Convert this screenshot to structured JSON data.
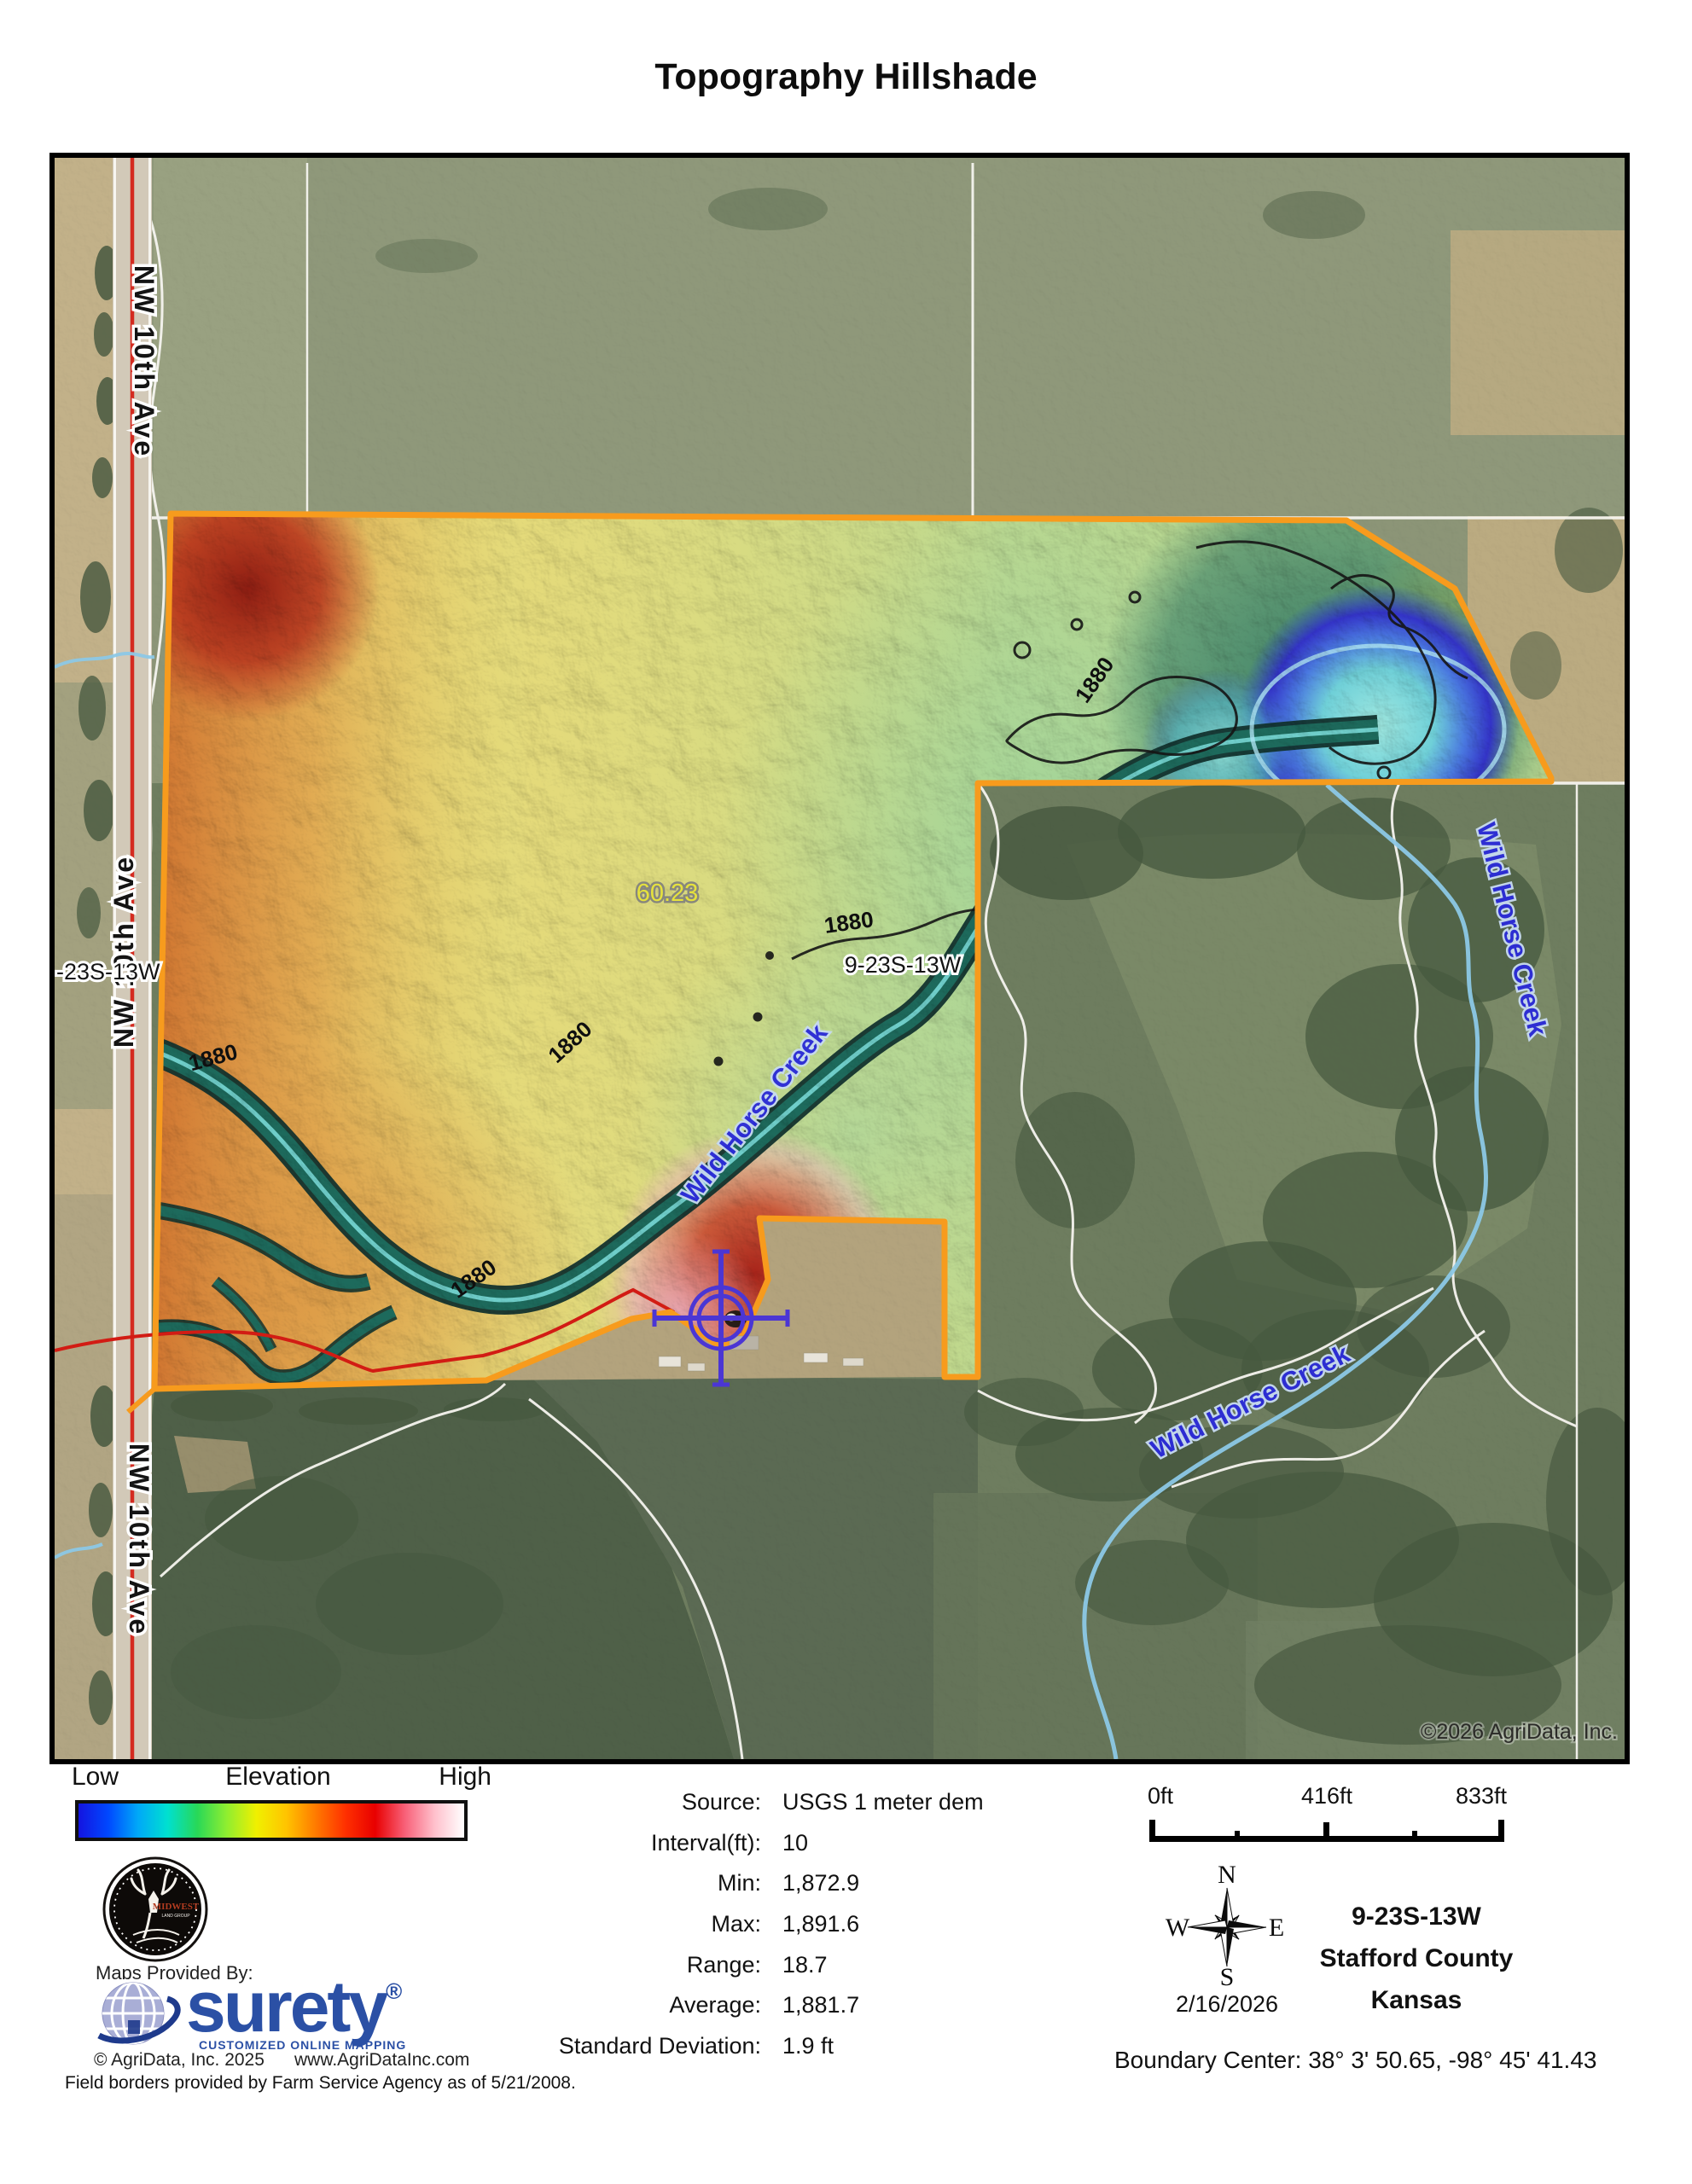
{
  "title": "Topography Hillshade",
  "map": {
    "copyright": "©2026 AgriData, Inc.",
    "road_label": "NW 10th Ave",
    "section_label_left": "-23S-13W",
    "section_label_center": "9-23S-13W",
    "acreage_label": "60.23",
    "creek_label": "Wild Horse Creek",
    "contour_label": "1880",
    "boundary_color": "#f79b1d",
    "creek_label_color": "#2b2bd8"
  },
  "legend": {
    "low": "Low",
    "title": "Elevation",
    "high": "High",
    "gradient": [
      "#1414e0",
      "#0048ff",
      "#00a8f8",
      "#00e0d0",
      "#28d858",
      "#90ee30",
      "#f0f000",
      "#ffc400",
      "#ff7a00",
      "#ff3000",
      "#e80000",
      "#f86078",
      "#ffc0cc",
      "#ffffff"
    ]
  },
  "stats": {
    "rows": [
      {
        "label": "Source:",
        "value": "USGS 1 meter dem"
      },
      {
        "label": "Interval(ft):",
        "value": "10"
      },
      {
        "label": "Min:",
        "value": "1,872.9"
      },
      {
        "label": "Max:",
        "value": "1,891.6"
      },
      {
        "label": "Range:",
        "value": "18.7"
      },
      {
        "label": "Average:",
        "value": "1,881.7"
      },
      {
        "label": "Standard Deviation:",
        "value": "1.9 ft"
      }
    ]
  },
  "scalebar": {
    "start": "0ft",
    "middle": "416ft",
    "end": "833ft"
  },
  "compass": {
    "north": "N",
    "east": "E",
    "south": "S",
    "west": "W",
    "date": "2/16/2026"
  },
  "location": {
    "section": "9-23S-13W",
    "county": "Stafford County",
    "state": "Kansas",
    "boundary_center": "Boundary Center: 38° 3' 50.65,  -98° 45' 41.43"
  },
  "branding": {
    "maps_provided_by": "Maps Provided By:",
    "brand": "surety",
    "registered": "®",
    "tagline": "CUSTOMIZED ONLINE MAPPING",
    "copyright": "© AgriData, Inc. 2025",
    "website": "www.AgriDataInc.com",
    "badge_line1": "MIDWEST",
    "badge_line2": "LAND GROUP",
    "brand_color": "#2b50a5"
  },
  "footer": "Field borders provided by Farm Service Agency as of 5/21/2008."
}
